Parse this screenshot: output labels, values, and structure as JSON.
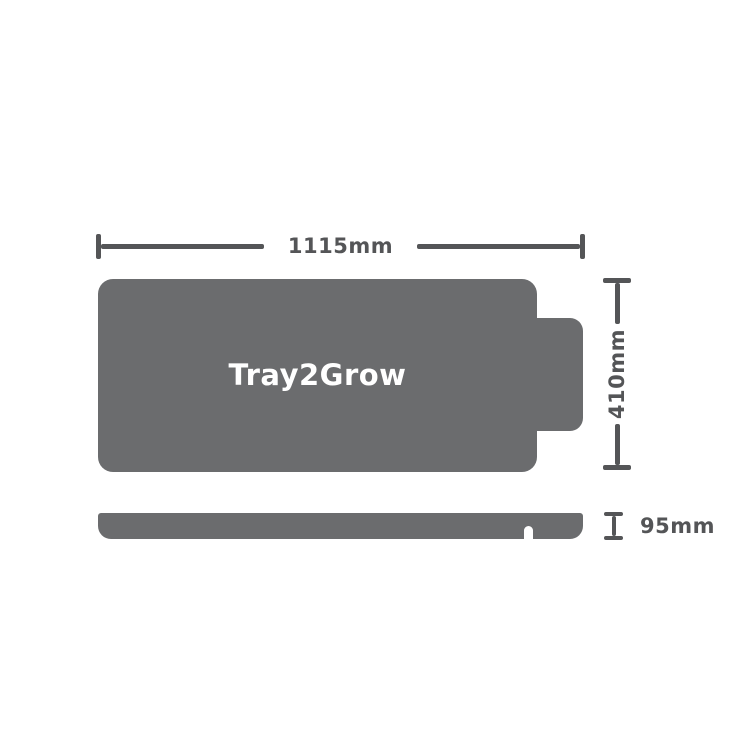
{
  "diagram": {
    "product_label": "Tray2Grow",
    "dimensions": {
      "width": "1115mm",
      "height": "410mm",
      "depth": "95mm"
    },
    "colors": {
      "shape": "#6B6C6E",
      "dimension": "#545557",
      "product_text": "#FFFFFF",
      "background": "#FFFFFF"
    }
  }
}
